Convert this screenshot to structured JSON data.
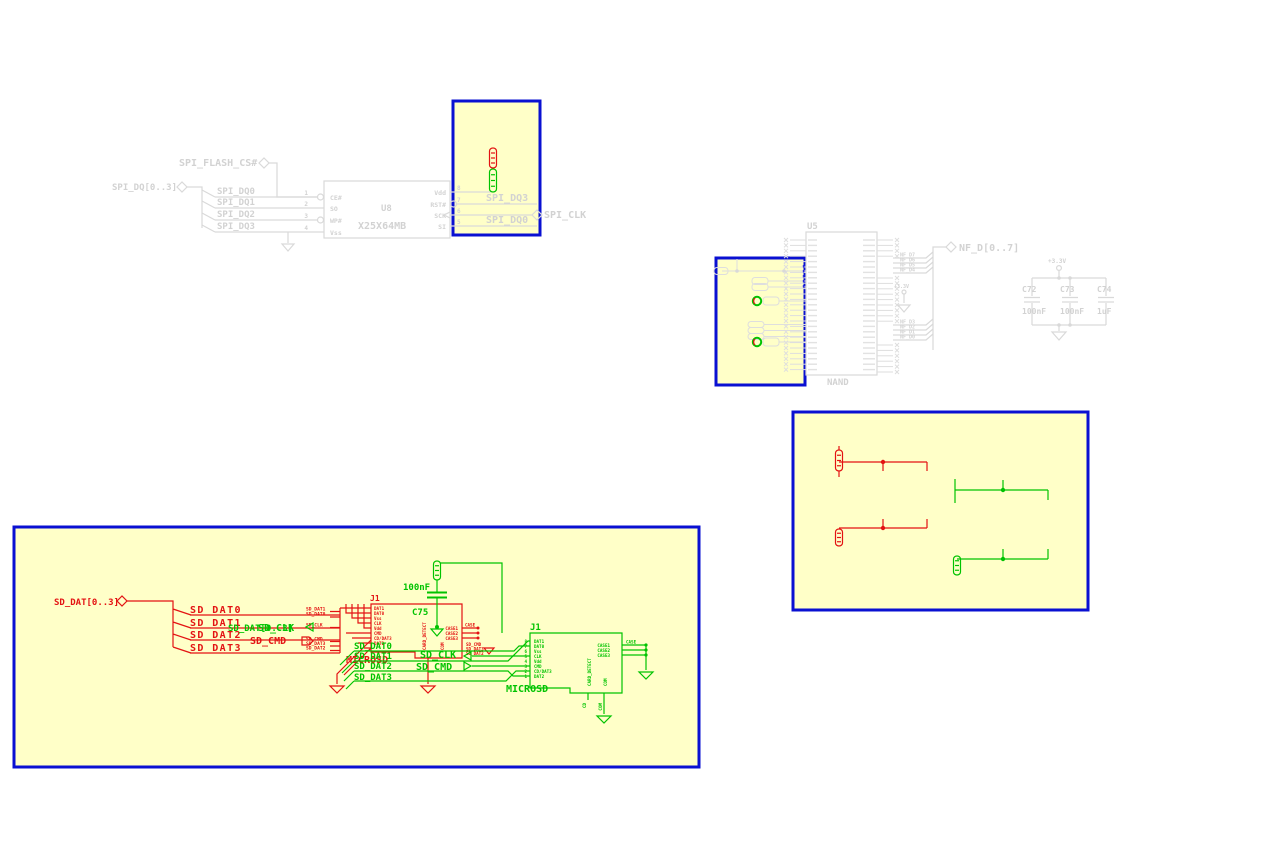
{
  "colors": {
    "removed": "#e31212",
    "added": "#00c300",
    "unchanged": "#d9d9d9",
    "highlight_fill": "#ffffc8",
    "highlight_border": "#0a10d2"
  },
  "spi_flash_section": {
    "ref": "U8",
    "value": "X25X64MB",
    "hier_label_cs": "SPI_FLASH_CS#",
    "hier_label_bus": "SPI_DQ[0..3]",
    "hier_label_clk": "SPI_CLK",
    "left_net_labels": [
      "SPI_DQ0",
      "SPI_DQ1",
      "SPI_DQ2",
      "SPI_DQ3"
    ],
    "left_pins": [
      {
        "num": "1",
        "name": "CE#"
      },
      {
        "num": "2",
        "name": "SO"
      },
      {
        "num": "3",
        "name": "WP#"
      },
      {
        "num": "4",
        "name": "Vss"
      }
    ],
    "right_pins": [
      {
        "num": "8",
        "name": "Vdd"
      },
      {
        "num": "7",
        "name": "RST#"
      },
      {
        "num": "6",
        "name": "SCK"
      },
      {
        "num": "5",
        "name": "SI"
      }
    ],
    "right_net_labels": [
      "SPI_DQ3",
      "SPI_DQ0"
    ]
  },
  "nand_section": {
    "ref": "U5",
    "value": "NAND",
    "bus_label": "NF_D[0..7]",
    "upper_data_labels": [
      "NF_D7",
      "NF_D6",
      "NF_D5",
      "NF_D4"
    ],
    "lower_data_labels": [
      "NF_D3",
      "NF_D2",
      "NF_D1",
      "NF_D0"
    ],
    "power_label": "+3.3V"
  },
  "decoupling_caps": {
    "power_label": "+3.3V",
    "caps": [
      {
        "ref": "C72",
        "value": "100nF"
      },
      {
        "ref": "C73",
        "value": "100nF"
      },
      {
        "ref": "C74",
        "value": "1uF"
      }
    ]
  },
  "sd_section": {
    "hier": {
      "bus": "SD_DAT[0..3]",
      "clk": "SD_CLK",
      "cmd": "SD_CMD"
    },
    "branch_labels": [
      "SD_DAT0",
      "SD_DAT1",
      "SD_DAT2",
      "SD_DAT3"
    ],
    "small_labels": [
      "SD_DAT1",
      "SD_DAT0",
      "SD_CLK",
      "SD_CMD",
      "SD_DAT3",
      "SD_DAT2"
    ],
    "small_labels_right": [
      "SD_CMD",
      "SD_DAT3",
      "SD_DAT2"
    ],
    "added_labels": [
      "SD_DAT0",
      "SD_DAT1",
      "SD_DAT2",
      "SD_DAT3"
    ],
    "connector": {
      "ref": "J1",
      "name": "MICROSD",
      "pins": [
        "DAT1",
        "DAT0",
        "Vss",
        "CLK",
        "Vdd",
        "CMD",
        "CD/DAT3",
        "DAT2"
      ],
      "numbers": [
        "8",
        "7",
        "6",
        "5",
        "4",
        "3",
        "2",
        "1"
      ],
      "case_pins": [
        "CASE1",
        "CASE2",
        "CASE3"
      ],
      "case_net": "CASE",
      "bottom_pins": [
        "CARD_DETECT",
        "COM"
      ],
      "bottom_nets": [
        "CD",
        "COM"
      ]
    },
    "cap": {
      "ref": "C75",
      "value": "100nF"
    }
  }
}
